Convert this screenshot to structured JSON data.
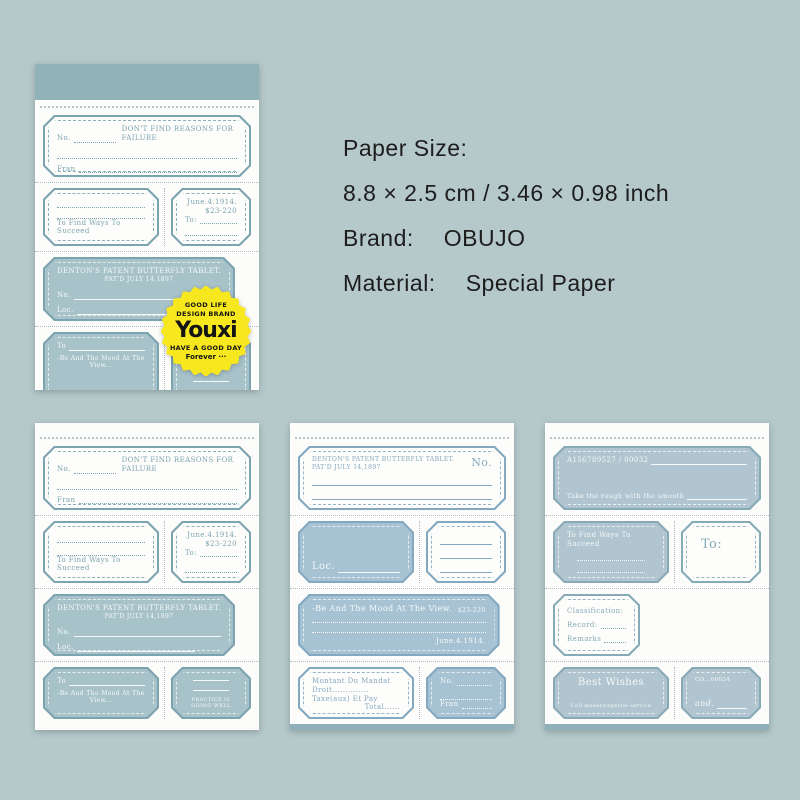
{
  "colors": {
    "background": "#b5c8ca",
    "pad_paper": "#fcfcfa",
    "accent_teal": "#7ca3b0",
    "fill_teal": "#a8c2ca",
    "accent_blue": "#84a8c0",
    "fill_blue": "#a7c3d3",
    "accent_slate": "#86aab6",
    "fill_slate": "#b0c5cf",
    "sticker_yellow": "#f6e71e",
    "binding_strip": "#92b2ba"
  },
  "specs": {
    "paper_size_label": "Paper Size:",
    "paper_size_value": "8.8 × 2.5 cm / 3.46 × 0.98 inch",
    "brand_label": "Brand:",
    "brand_value": "OBUJO",
    "material_label": "Material:",
    "material_value": "Special Paper"
  },
  "sticker": {
    "line1": "GOOD LIFE",
    "line2": "DESIGN BRAND",
    "brand": "Youxi",
    "line3": "HAVE A GOOD DAY",
    "line4": "Forever ···"
  },
  "labels_a": {
    "no": "No.",
    "slogan": "DON'T FIND REASONS FOR FAILURE",
    "fran": "Fran",
    "succeed": "To Find Ways To Succeed",
    "date": "June.4.1914.",
    "price": "$23-220",
    "to": "To:",
    "denton1": "DENTON'S PATENT BUTTERFLY TABLET.",
    "denton2": "PAT'D JULY 14,1897",
    "loc": "Loc.",
    "to2": "To",
    "mood": "-Be And The Mood At The View...",
    "practice": "PRACTICE IS GOING WELL"
  },
  "labels_c": {
    "denton1": "DENTON'S PATENT BUTTERFLY TABLET.",
    "denton2": "PAT'D JULY 14,1897",
    "no": "No.",
    "loc": "Loc.",
    "mood": "-Be And The Mood At The View.",
    "price": "$23-220",
    "date": "June.4.1914.",
    "montant": "Montant Du Mandat",
    "droit": "Droit..............",
    "taxe": "Taxe(aux) Et Pay",
    "total": "Total......",
    "no2": "No.",
    "fran": "Fran"
  },
  "labels_d": {
    "serial": "A156789527 / 00032",
    "smooth": "Take the rough with the smooth",
    "succeed": "To Find Ways To Succeed",
    "to": "To:",
    "classification": "Classification:",
    "record": "Record:",
    "remarks": "Remarks",
    "wishes": "Best Wishes",
    "service": "Call-makers/special-service",
    "co": "CO...00034",
    "and": "and."
  }
}
